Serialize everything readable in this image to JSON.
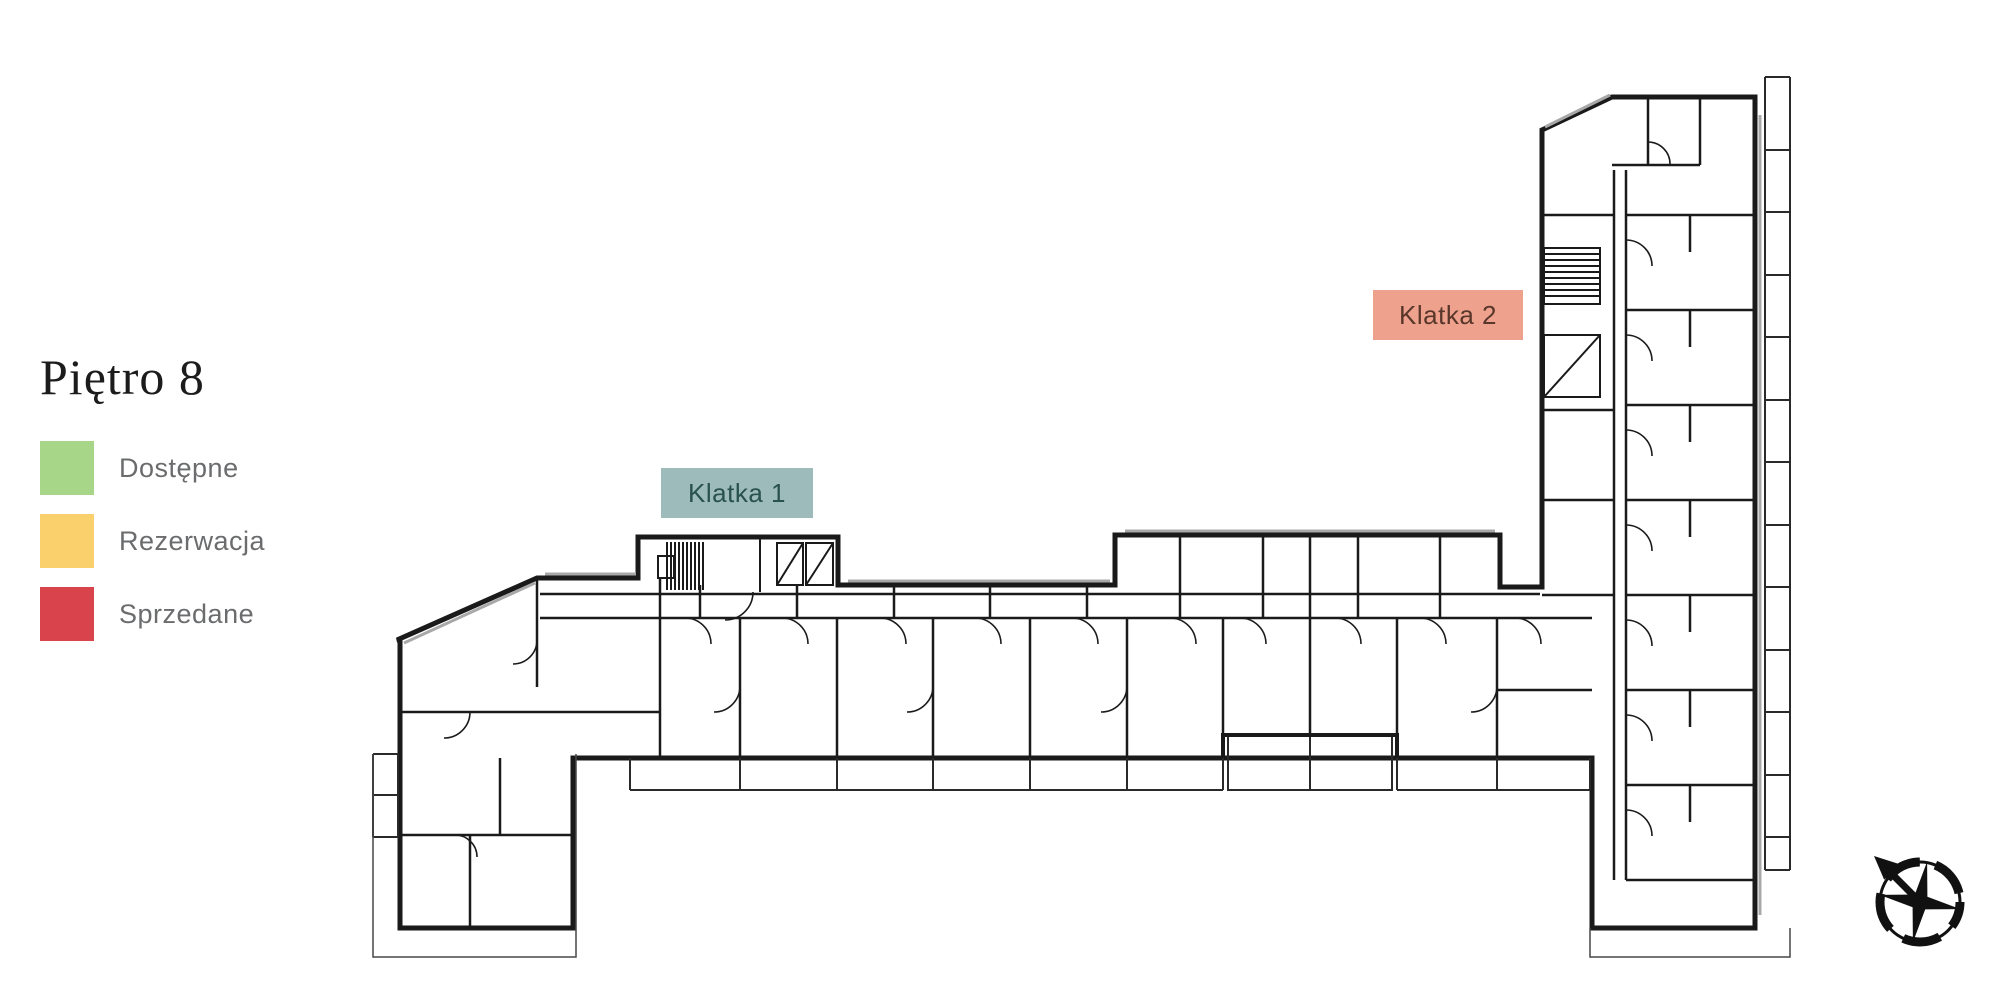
{
  "header": {
    "title": "Piętro 8"
  },
  "legend": {
    "items": [
      {
        "label": "Dostępne",
        "color": "#a7d688",
        "status": "available"
      },
      {
        "label": "Rezerwacja",
        "color": "#f9d06b",
        "status": "reserved"
      },
      {
        "label": "Sprzedane",
        "color": "#d8434c",
        "status": "sold"
      }
    ]
  },
  "floorplan": {
    "stairwell_labels": [
      {
        "text": "Klatka 1",
        "background": "#9dbbbb",
        "text_color": "#29514f"
      },
      {
        "text": "Klatka 2",
        "background": "#eea28d",
        "text_color": "#59362a"
      }
    ],
    "compass_icon": "compass-rose-pointing-north-west",
    "line_color": "#1a1a1a"
  }
}
